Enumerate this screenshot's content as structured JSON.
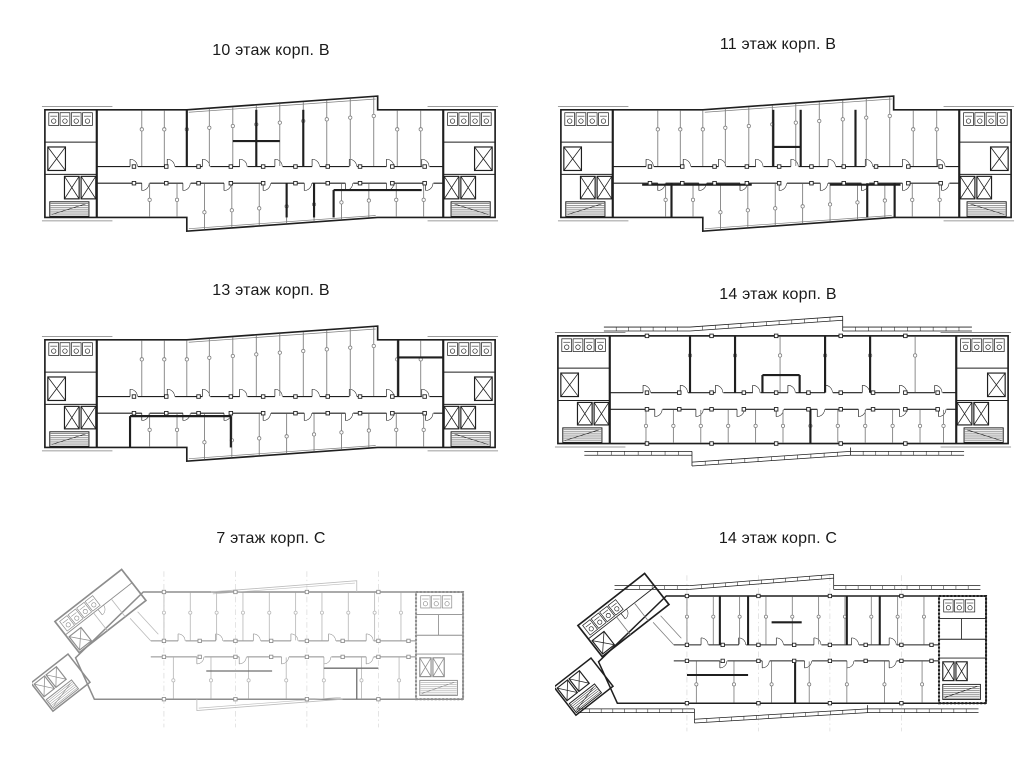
{
  "page": {
    "background": "#ffffff"
  },
  "colors": {
    "ink": "#1f1f1f",
    "medium": "#6f6f6f",
    "thin": "#7d7d7d",
    "faint": "#bdbdbd",
    "grid": "#cfcfcf",
    "light_ink": "#8d8d8d",
    "light_thin": "#b9b9b9",
    "background": "#ffffff"
  },
  "plans": [
    {
      "label": "10 этаж корп. B",
      "floor": "10",
      "corpus": "B"
    },
    {
      "label": "11 этаж корп. B",
      "floor": "11",
      "corpus": "B"
    },
    {
      "label": "13 этаж корп. B",
      "floor": "13",
      "corpus": "B"
    },
    {
      "label": "14 этаж корп. B",
      "floor": "14",
      "corpus": "B"
    },
    {
      "label": "7 этаж корп. C",
      "floor": "7",
      "corpus": "C"
    },
    {
      "label": "14 этаж корп. C",
      "floor": "14",
      "corpus": "C"
    }
  ]
}
